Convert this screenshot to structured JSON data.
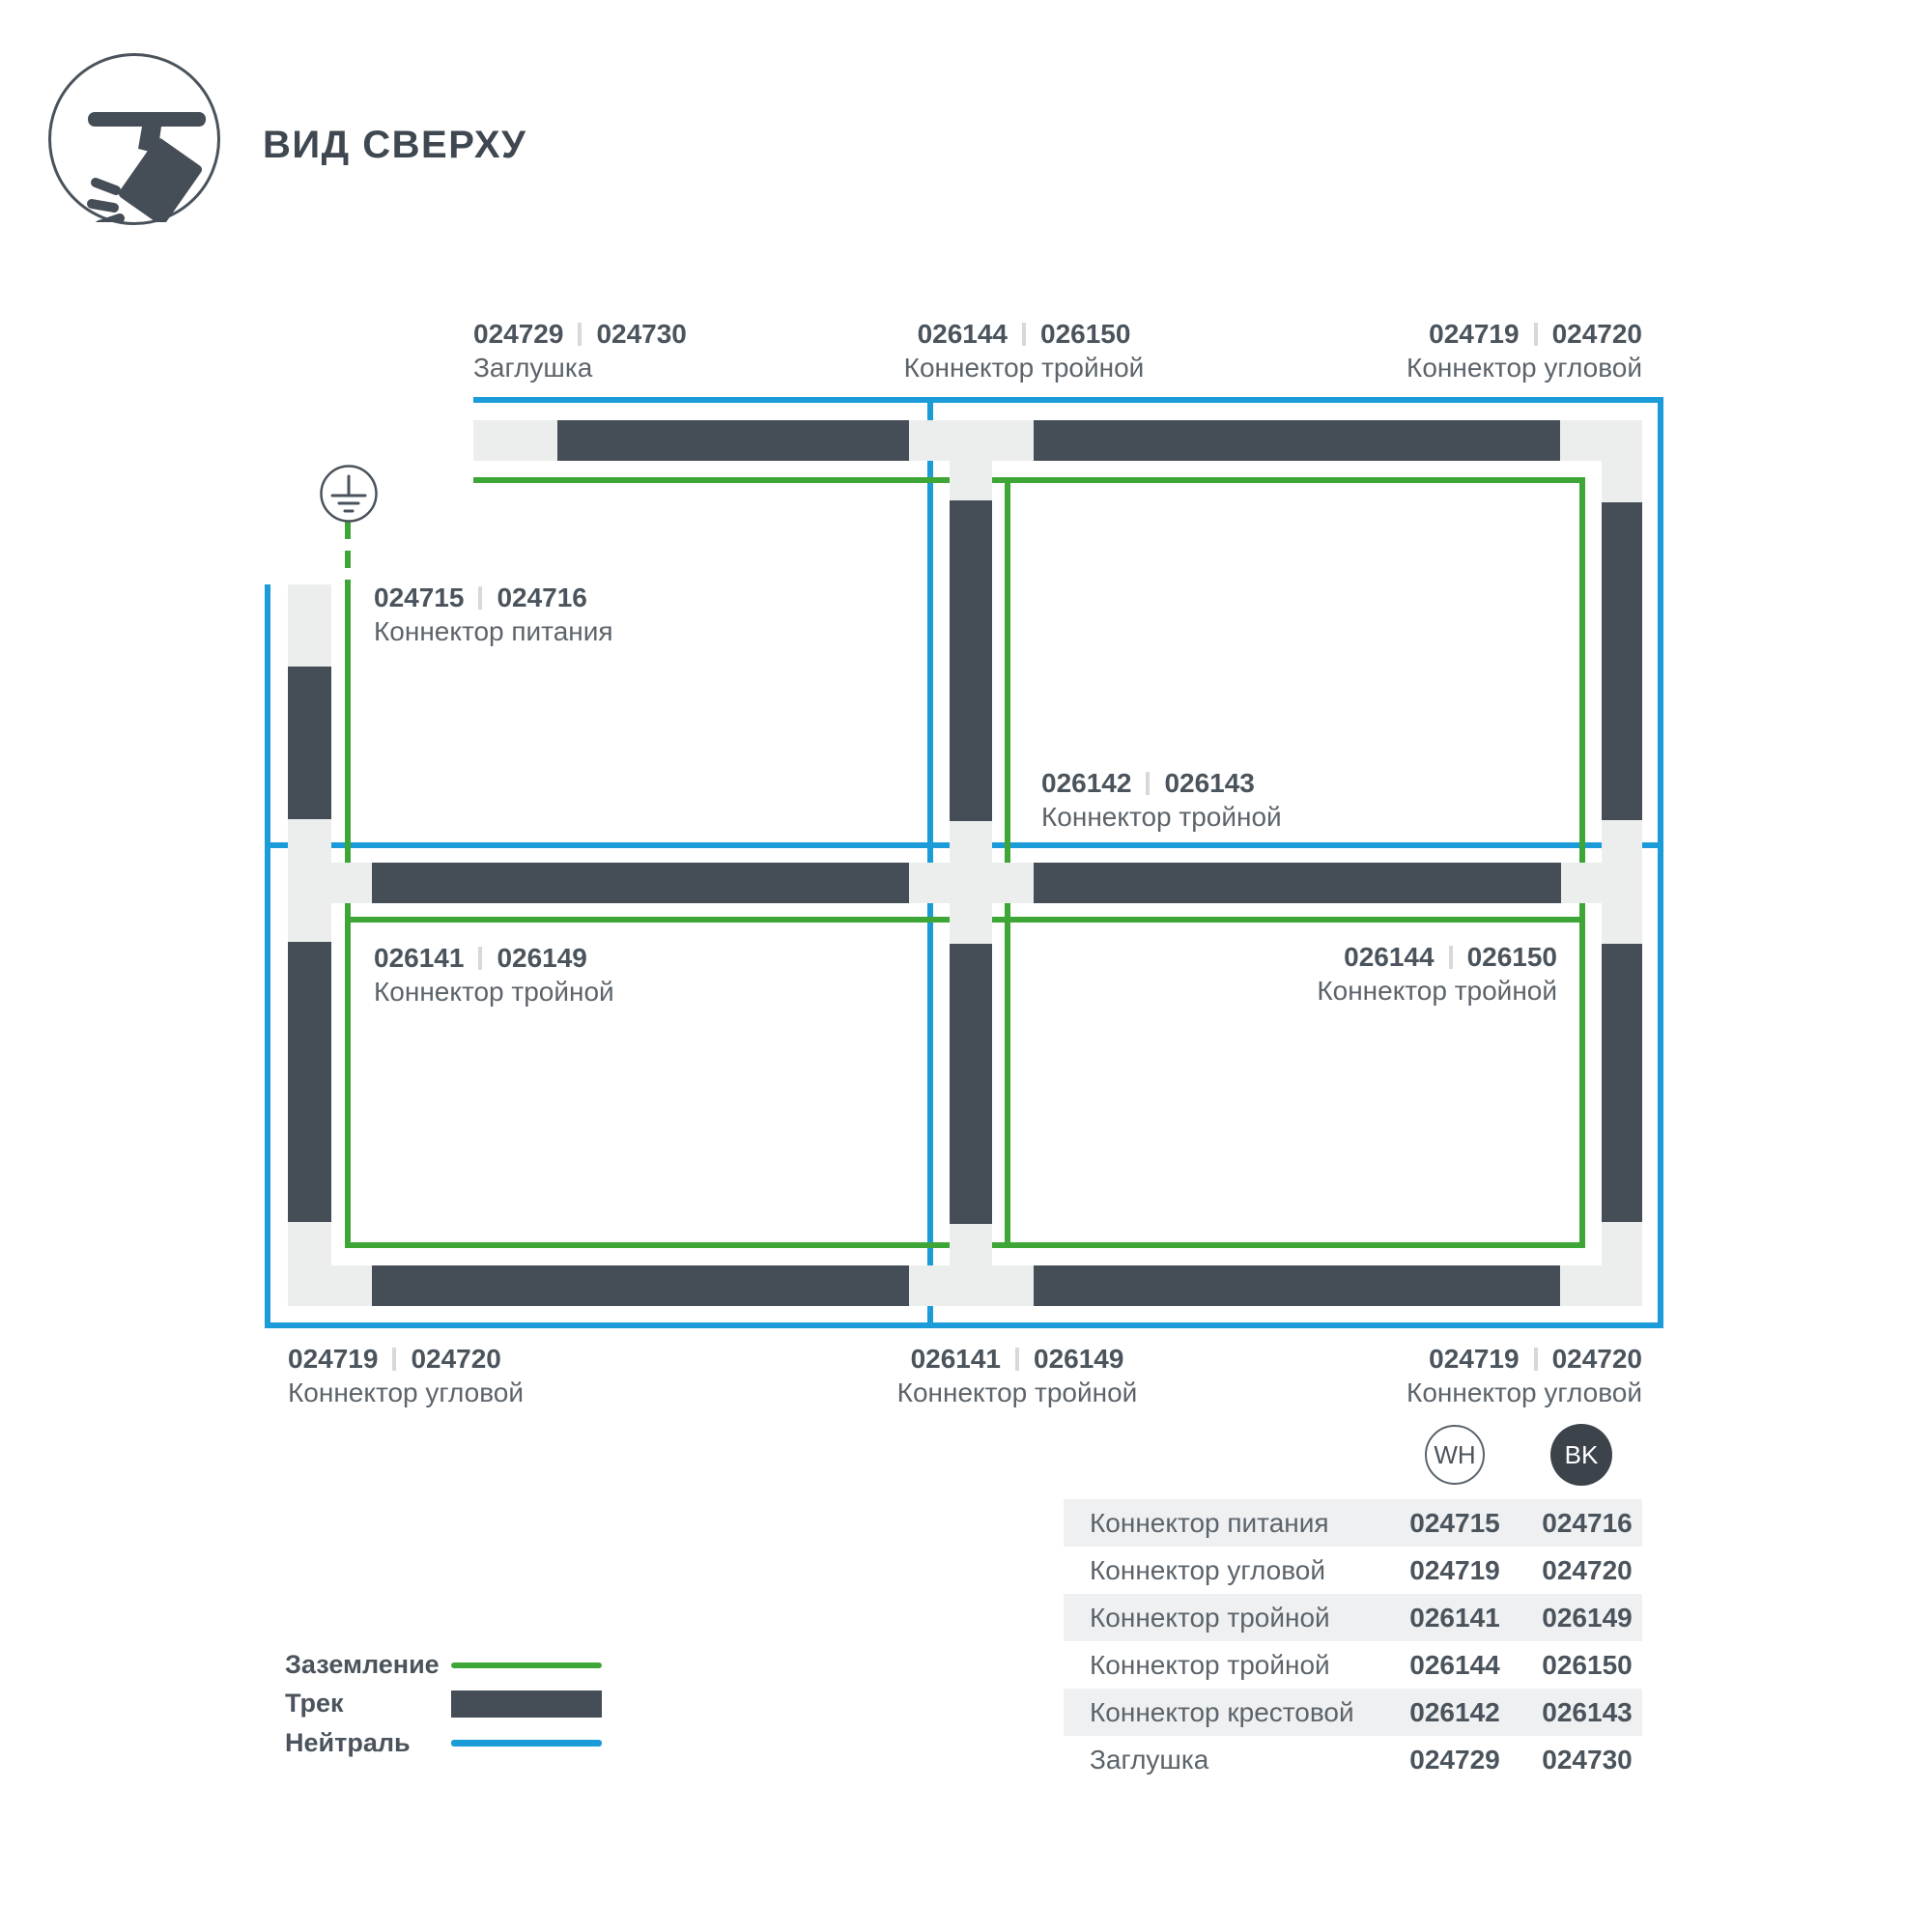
{
  "title": "ВИД СВЕРХУ",
  "callouts": [
    {
      "wh": "024729",
      "bk": "024730",
      "caption": "Заглушка"
    },
    {
      "wh": "026144",
      "bk": "026150",
      "caption": "Коннектор тройной"
    },
    {
      "wh": "024719",
      "bk": "024720",
      "caption": "Коннектор угловой"
    },
    {
      "wh": "024715",
      "bk": "024716",
      "caption": "Коннектор питания"
    },
    {
      "wh": "026142",
      "bk": "026143",
      "caption": "Коннектор тройной"
    },
    {
      "wh": "026141",
      "bk": "026149",
      "caption": "Коннектор тройной"
    },
    {
      "wh": "026144",
      "bk": "026150",
      "caption": "Коннектор тройной"
    },
    {
      "wh": "024719",
      "bk": "024720",
      "caption": "Коннектор угловой"
    },
    {
      "wh": "026141",
      "bk": "026149",
      "caption": "Коннектор тройной"
    },
    {
      "wh": "024719",
      "bk": "024720",
      "caption": "Коннектор угловой"
    }
  ],
  "legend": {
    "items": [
      {
        "label": "Заземление"
      },
      {
        "label": "Трек"
      },
      {
        "label": "Нейтраль"
      }
    ]
  },
  "badges": {
    "wh": "WH",
    "bk": "BK"
  },
  "table": {
    "rows": [
      {
        "name": "Коннектор питания",
        "wh": "024715",
        "bk": "024716"
      },
      {
        "name": "Коннектор угловой",
        "wh": "024719",
        "bk": "024720"
      },
      {
        "name": "Коннектор тройной",
        "wh": "026141",
        "bk": "026149"
      },
      {
        "name": "Коннектор тройной",
        "wh": "026144",
        "bk": "026150"
      },
      {
        "name": "Коннектор крестовой",
        "wh": "026142",
        "bk": "026143"
      },
      {
        "name": "Заглушка",
        "wh": "024729",
        "bk": "024730"
      }
    ]
  },
  "colors": {
    "track": "#454d56",
    "connector": "#eceeee",
    "neutral": "#1b9cd8",
    "ground": "#3ea636",
    "text": "#4b545c"
  }
}
